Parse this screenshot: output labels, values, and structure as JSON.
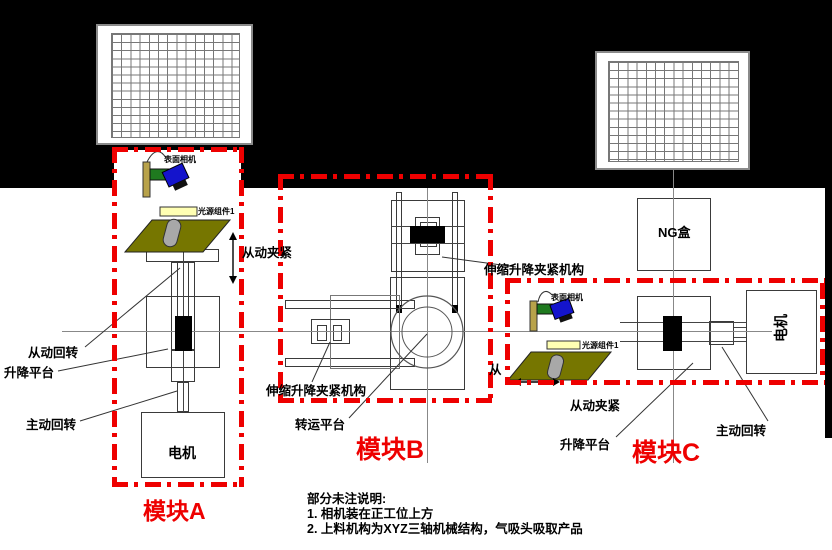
{
  "diagram": {
    "module_a": {
      "name": "模块A",
      "surface_camera": "表面相机",
      "light_source": "光源组件1",
      "passive_clamp": "从动夹紧",
      "passive_rotation": "从动回转",
      "lift_platform": "升降平台",
      "active_rotation": "主动回转",
      "motor": "电机"
    },
    "module_b": {
      "name": "模块B",
      "telescopic_clamp": "伸缩升降夹紧机构",
      "transfer_platform": "转运平台"
    },
    "module_c": {
      "name": "模块C",
      "telescopic_clamp": "伸缩升降夹紧机构",
      "surface_camera": "表面相机",
      "light_source": "光源组件1",
      "ng_box": "NG盒",
      "partial_clamp_char": "从",
      "passive_clamp": "从动夹紧",
      "lift_platform": "升降平台",
      "active_rotation": "主动回转",
      "motor": "电机"
    },
    "notes": {
      "title": "部分未注说明:",
      "line1": "1. 相机装在正工位上方",
      "line2": "2. 上料机构为XYZ三轴机械结构，气吸头吸取产品"
    },
    "colors": {
      "accent_red": "#ee0000",
      "olive_plate": "#767600",
      "light_yellow_bar": "#ffffb3",
      "camera_green": "#1f7a1f",
      "camera_blue": "#1414cc",
      "bracket_khaki": "#b8a24a",
      "cylinder_gray": "#a8a8a8",
      "line_gray": "#888888"
    }
  }
}
